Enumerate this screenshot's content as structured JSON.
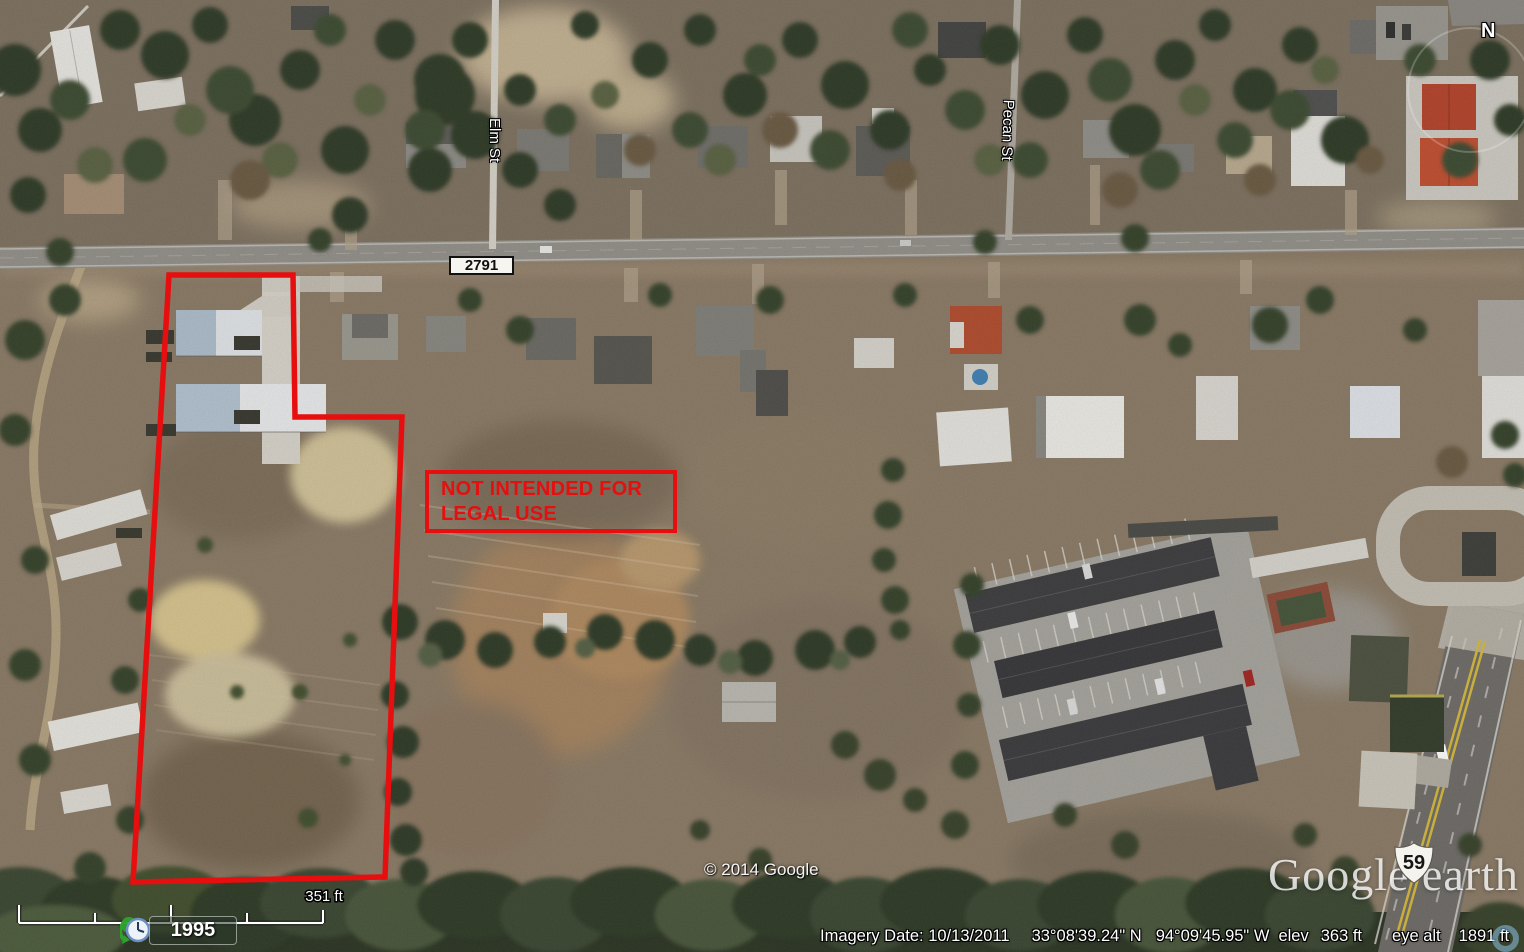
{
  "map_labels": {
    "fm_road_shield": "2791",
    "us_route_shield": "59",
    "street_elm": "Elm St",
    "street_pecan": "Pecan St"
  },
  "annotation": {
    "warning_line1": "NOT INTENDED FOR",
    "warning_line2": "LEGAL USE",
    "color": "#e60e0e"
  },
  "branding": {
    "logo": "Google earth",
    "copyright": "© 2014 Google"
  },
  "status_bar": {
    "imagery_date": "Imagery Date: 10/13/2011",
    "latitude": "33°08'39.24\" N",
    "longitude": "94°09'45.95\" W",
    "elev_label": "elev",
    "elev_value": "363 ft",
    "eye_alt_label": "eye alt",
    "eye_alt_value": "1891 ft"
  },
  "scale_bar": {
    "label": "351 ft"
  },
  "time_indicator": {
    "year": "1995"
  },
  "compass": {
    "label": "N"
  }
}
